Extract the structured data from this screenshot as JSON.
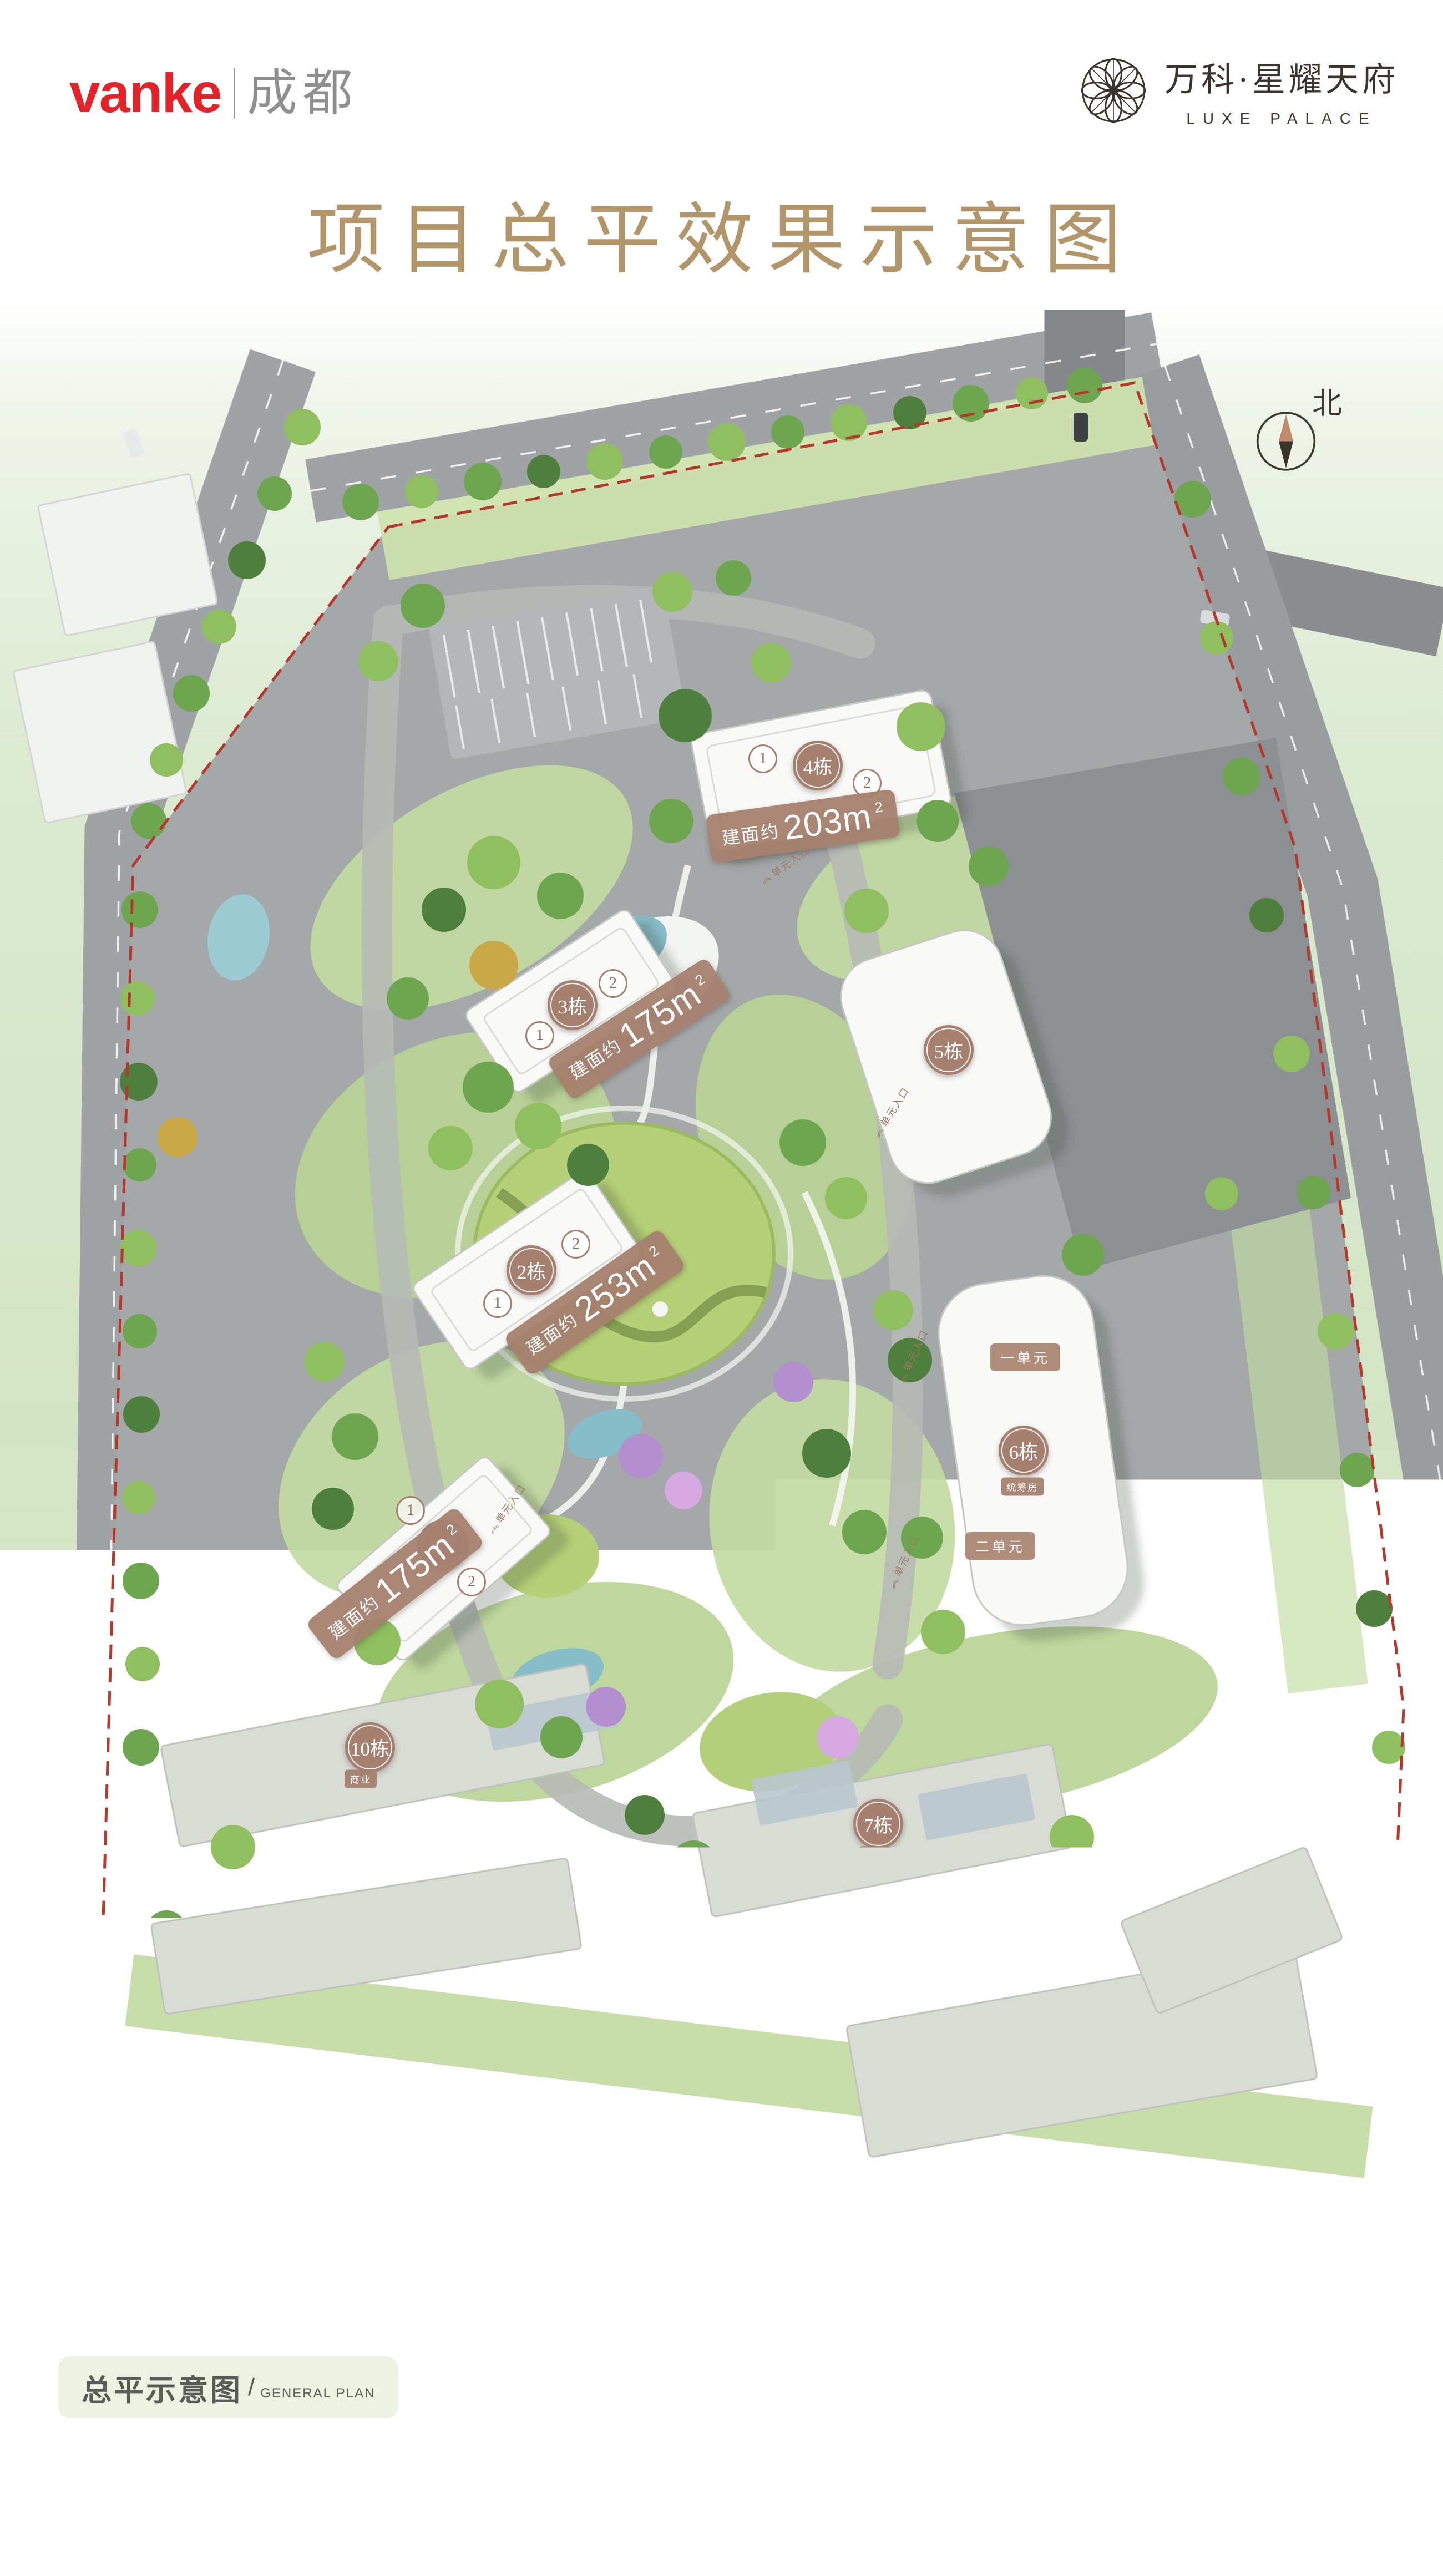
{
  "header": {
    "brand": "vanke",
    "city": "成都",
    "logo_name": "万科·星耀天府",
    "logo_sub": "LUXE PALACE",
    "title": "项目总平效果示意图"
  },
  "plan": {
    "north_label": "北",
    "entrance_label": "单元入口",
    "entrance_arrow": "《",
    "towers": [
      {
        "name": "1栋",
        "area_prefix": "建面约",
        "area_value": "175m",
        "area_sup": "2",
        "units": [
          "1",
          "2"
        ]
      },
      {
        "name": "2栋",
        "area_prefix": "建面约",
        "area_value": "253m",
        "area_sup": "2",
        "units": [
          "1",
          "2"
        ]
      },
      {
        "name": "3栋",
        "area_prefix": "建面约",
        "area_value": "175m",
        "area_sup": "2",
        "units": [
          "1",
          "2"
        ]
      },
      {
        "name": "4栋",
        "area_prefix": "建面约",
        "area_value": "203m",
        "area_sup": "2",
        "units": [
          "1",
          "2"
        ]
      }
    ],
    "blocks": [
      {
        "name": "5栋"
      },
      {
        "name": "6栋",
        "tag": "统筹房",
        "units": [
          "一单元",
          "二单元"
        ]
      },
      {
        "name": "7栋",
        "tag": "商业"
      },
      {
        "name": "8栋",
        "tag": "商业",
        "units": [
          "一单元",
          "二单元",
          "三单元"
        ]
      },
      {
        "name": "9栋",
        "tag": "商业"
      },
      {
        "name": "10栋",
        "tag": "商业"
      }
    ]
  },
  "footer": {
    "caption_zh": "总平示意图",
    "caption_sep": "/",
    "caption_en": "GENERAL PLAN",
    "disclaimer": [
      "本图为万科·星耀天府（备案名：万科星耀阁）总平规划效果示意图，内容仅为要约邀请，买卖双方权利义务以买卖合同为准。本图以政府规划部门批准的规划方案为依据绘制，",
      "与实景存在差异，细节以规划方案为准；在建设过程中可能因政府或其他有权单位要求而修改，在不违反合同约定的前提下，本公司亦有权做出细部调整。",
      "*特殊房源说明：2栋、4栋顶层房屋为非标跃层户型，2栋21层跃层户型建面约365㎡、4栋23层跃层户型建面约346㎡。1-5栋2层房屋受外立面装饰、入户门头等影响，存在一",
      "定视线遮挡，具体以实际交付为准。3栋3-1-201、3-1-301、3-1-401、3-1-501为《成都市规划管理技术规定》中的公寓。",
      "*楼栋分布说明：1栋地上总层数为23F，2栋地上总层数为22F，3栋、4栋、5栋地上总层数为24F，6栋1单元（统筹房）地上总层数为22F，6栋2单元（统筹房）地上总层数为",
      "20F，7栋、8栋、9栋、10栋（商业）地上总层数为2F。其中4、5、6栋负一层分布部分商业用房。",
      "开发商：成都鼎骏置业有限公司；代理公司：珠海蓉万唯家房地产经纪有限公司/成都方圆房地产营销置业有限公司/成都易居祥悦不动产顾问有限公司；制作时间：2021年8月。"
    ]
  }
}
